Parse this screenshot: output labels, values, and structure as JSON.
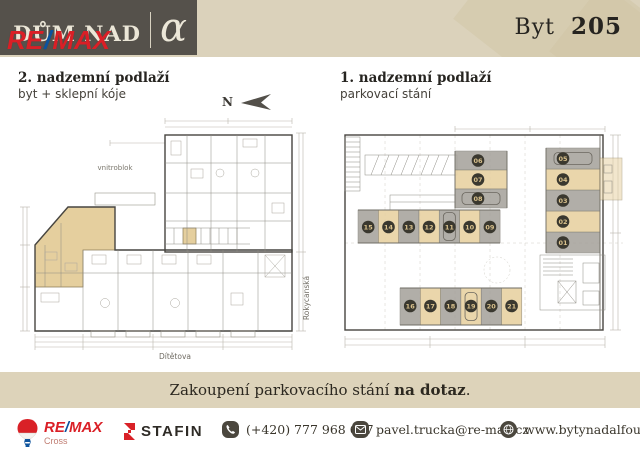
{
  "header": {
    "brand_title": "DŮM NAD",
    "brand_alpha": "α",
    "remax": {
      "re": "RE",
      "slash": "/",
      "max": "MAX"
    },
    "unit_label": "Byt",
    "unit_number": "205"
  },
  "left_plan": {
    "title": "2. nadzemní podlaží",
    "subtitle": "byt + sklepní kóje",
    "north_label": "N",
    "labels": {
      "courtyard": "vnitroblok",
      "street_right": "Rokycanská",
      "street_bottom": "Dítětova"
    }
  },
  "right_plan": {
    "title": "1. nadzemní podlaží",
    "subtitle": "parkovací stání",
    "stalls": [
      {
        "label": "01",
        "x": 211,
        "y": 119,
        "w": 54,
        "h": 21,
        "fill": "g",
        "orient": "h",
        "car": false,
        "bx": 228,
        "by": 129.5
      },
      {
        "label": "02",
        "x": 211,
        "y": 98,
        "w": 54,
        "h": 21,
        "fill": "t",
        "orient": "h",
        "car": false,
        "bx": 228,
        "by": 108.5
      },
      {
        "label": "03",
        "x": 211,
        "y": 77,
        "w": 54,
        "h": 21,
        "fill": "g",
        "orient": "h",
        "car": false,
        "bx": 228,
        "by": 87.5
      },
      {
        "label": "04",
        "x": 211,
        "y": 56,
        "w": 54,
        "h": 21,
        "fill": "t",
        "orient": "h",
        "car": false,
        "bx": 228,
        "by": 66.5
      },
      {
        "label": "05",
        "x": 211,
        "y": 35,
        "w": 54,
        "h": 21,
        "fill": "g",
        "orient": "h",
        "car": true,
        "bx": 228,
        "by": 45.5
      },
      {
        "label": "06",
        "x": 120,
        "y": 38,
        "w": 52,
        "h": 19,
        "fill": "g",
        "orient": "h",
        "car": false,
        "bx": 143,
        "by": 47.5
      },
      {
        "label": "07",
        "x": 120,
        "y": 57,
        "w": 52,
        "h": 19,
        "fill": "t",
        "orient": "h",
        "car": false,
        "bx": 143,
        "by": 66.5
      },
      {
        "label": "08",
        "x": 120,
        "y": 76,
        "w": 52,
        "h": 19,
        "fill": "g",
        "orient": "h",
        "car": true,
        "bx": 143,
        "by": 85.5
      },
      {
        "label": "09",
        "x": 144.8,
        "y": 97,
        "w": 20.3,
        "h": 33,
        "fill": "g",
        "orient": "v",
        "car": false,
        "bx": 154.9,
        "by": 114
      },
      {
        "label": "10",
        "x": 124.5,
        "y": 97,
        "w": 20.3,
        "h": 33,
        "fill": "t",
        "orient": "v",
        "car": false,
        "bx": 134.6,
        "by": 114
      },
      {
        "label": "11",
        "x": 104.2,
        "y": 97,
        "w": 20.3,
        "h": 33,
        "fill": "g",
        "orient": "v",
        "car": true,
        "bx": 114.4,
        "by": 114
      },
      {
        "label": "12",
        "x": 83.9,
        "y": 97,
        "w": 20.3,
        "h": 33,
        "fill": "t",
        "orient": "v",
        "car": false,
        "bx": 94,
        "by": 114
      },
      {
        "label": "13",
        "x": 63.6,
        "y": 97,
        "w": 20.3,
        "h": 33,
        "fill": "g",
        "orient": "v",
        "car": false,
        "bx": 73.8,
        "by": 114
      },
      {
        "label": "14",
        "x": 43.3,
        "y": 97,
        "w": 20.3,
        "h": 33,
        "fill": "t",
        "orient": "v",
        "car": false,
        "bx": 53.5,
        "by": 114
      },
      {
        "label": "15",
        "x": 23,
        "y": 97,
        "w": 20.3,
        "h": 33,
        "fill": "g",
        "orient": "v",
        "car": false,
        "bx": 33.2,
        "by": 114
      },
      {
        "label": "16",
        "x": 65,
        "y": 175,
        "w": 20.3,
        "h": 37,
        "fill": "g",
        "orient": "v",
        "car": false,
        "bx": 75.2,
        "by": 193
      },
      {
        "label": "17",
        "x": 85.3,
        "y": 175,
        "w": 20.3,
        "h": 37,
        "fill": "t",
        "orient": "v",
        "car": false,
        "bx": 95.4,
        "by": 193
      },
      {
        "label": "18",
        "x": 105.6,
        "y": 175,
        "w": 20.3,
        "h": 37,
        "fill": "g",
        "orient": "v",
        "car": false,
        "bx": 115.7,
        "by": 193
      },
      {
        "label": "19",
        "x": 125.9,
        "y": 175,
        "w": 20.3,
        "h": 37,
        "fill": "t",
        "orient": "v",
        "car": true,
        "bx": 136,
        "by": 193
      },
      {
        "label": "20",
        "x": 146.2,
        "y": 175,
        "w": 20.3,
        "h": 37,
        "fill": "g",
        "orient": "v",
        "car": false,
        "bx": 156.3,
        "by": 193
      },
      {
        "label": "21",
        "x": 166.5,
        "y": 175,
        "w": 20.3,
        "h": 37,
        "fill": "t",
        "orient": "v",
        "car": false,
        "bx": 176.6,
        "by": 193
      }
    ]
  },
  "banner": {
    "pre": "Zakoupení parkovacího stání ",
    "bold": "na dotaz",
    "post": "."
  },
  "footer": {
    "remax_wordmark": {
      "re": "RE",
      "slash": "/",
      "max": "MAX"
    },
    "remax_sub": "Cross",
    "stafin": "STAFIN",
    "phone": "(+420) 777 968 697",
    "email": "pavel.trucka@re-max.cz",
    "web": "www.bytynadalfou.cz"
  },
  "colors": {
    "stall_gray": "#a4a19a",
    "stall_tan": "#e8d2a2",
    "badge_bg": "#3a382f",
    "badge_text": "#d9c18c",
    "highlight_tan": "#e5cf9e",
    "accent_red": "#da1f26",
    "accent_blue": "#0a53a0"
  }
}
